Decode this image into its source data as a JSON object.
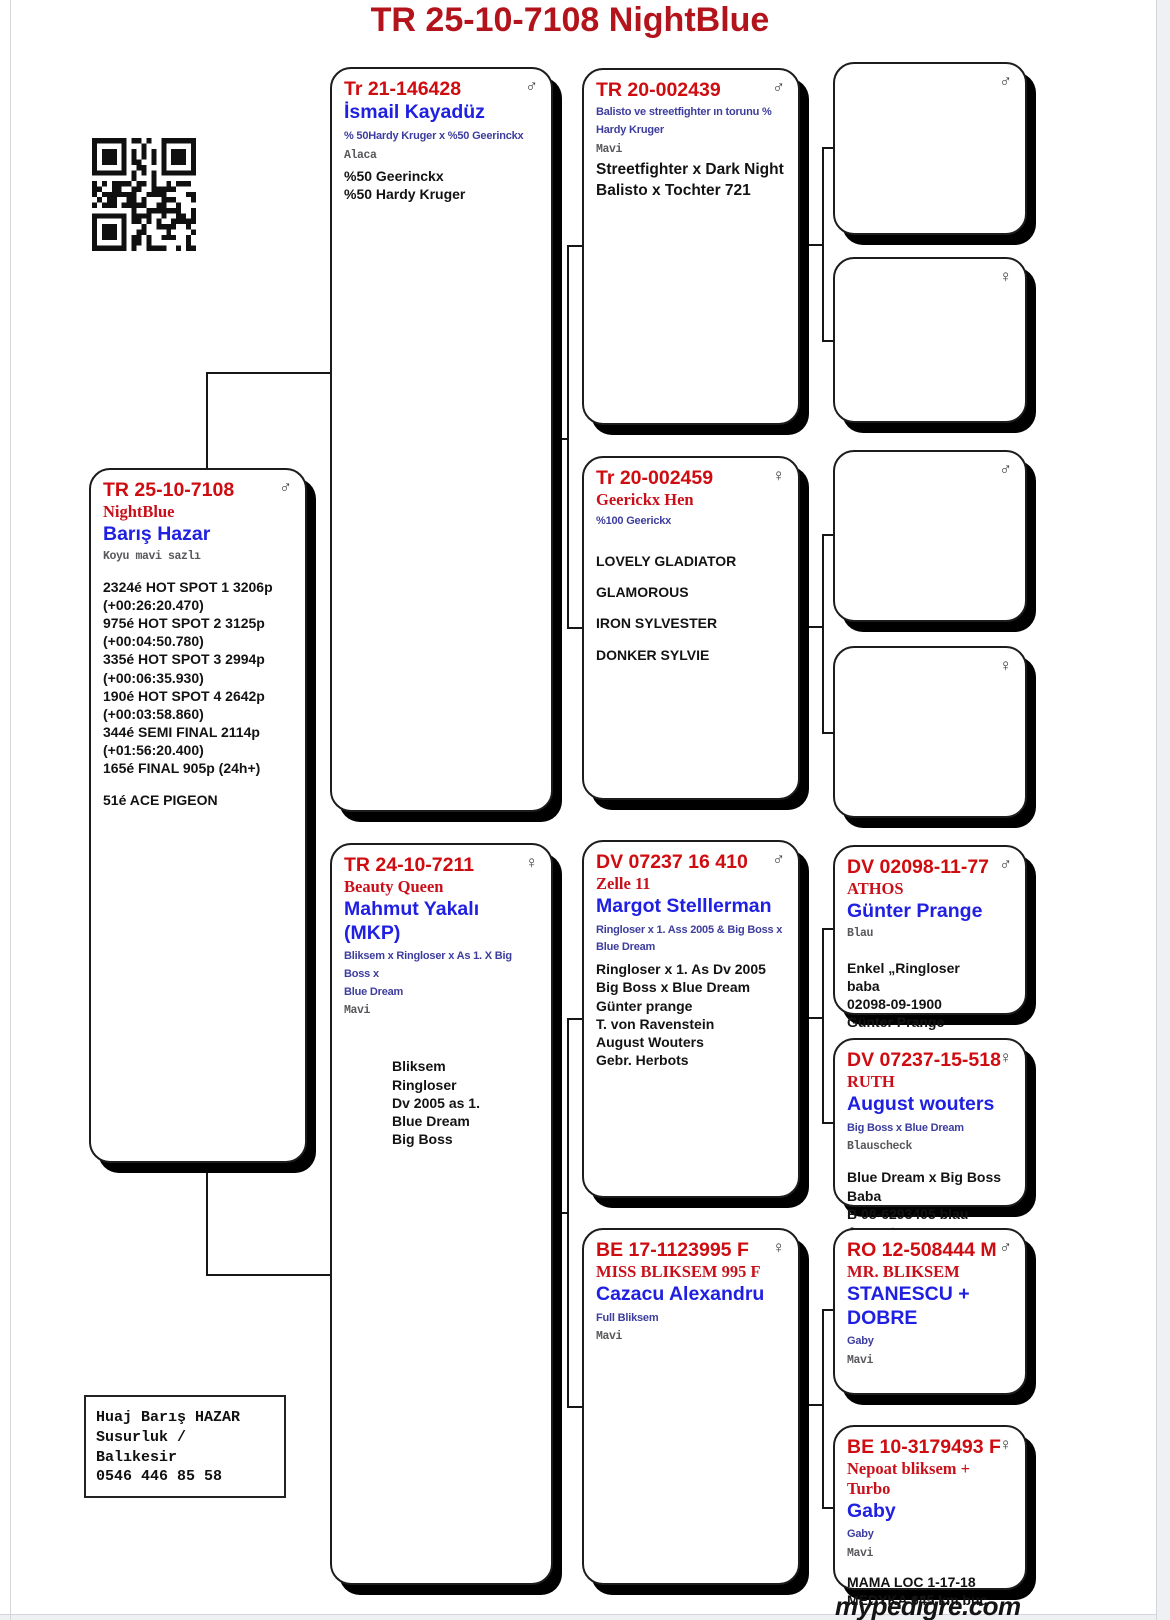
{
  "page": {
    "title": "TR 25-10-7108  NightBlue",
    "footer_logo": "mypedigre.com",
    "colors": {
      "title_red": "#b3141c",
      "ring_red": "#cf0c10",
      "name_blue": "#2020e2",
      "desc_blue": "#3d3d9f"
    }
  },
  "contact": {
    "lines": [
      "Huaj Barış HAZAR",
      "Susurluk / Balıkesir",
      "0546 446 85 58"
    ]
  },
  "boxes": {
    "subject": {
      "ring": "TR 25-10-7108",
      "sex": "♂",
      "name2": "NightBlue",
      "owner": "Barış Hazar",
      "color_line": "Koyu mavi sazlı",
      "info": [
        "2324é HOT SPOT 1 3206p",
        "(+00:26:20.470)",
        "975é HOT SPOT 2 3125p",
        "(+00:04:50.780)",
        "335é HOT SPOT 3 2994p",
        "(+00:06:35.930)",
        "190é HOT SPOT 4 2642p",
        "(+00:03:58.860)",
        "344é SEMI FINAL 2114p",
        "(+01:56:20.400)",
        "165é FINAL 905p (24h+)",
        "",
        "51é ACE PIGEON"
      ]
    },
    "sire": {
      "ring": "Tr 21-146428",
      "sex": "♂",
      "owner": "İsmail Kayadüz",
      "desc": [
        "% 50Hardy Kruger x %50 Geerinckx"
      ],
      "color_line": "Alaca",
      "info": [
        "%50 Geerinckx",
        "%50 Hardy Kruger"
      ]
    },
    "dam": {
      "ring": "TR 24-10-7211",
      "sex": "♀",
      "name2": "Beauty Queen",
      "owner": "Mahmut Yakalı (MKP)",
      "desc": [
        "Bliksem x Ringloser x As 1. X Big Boss x",
        "Blue Dream"
      ],
      "color_line": "Mavi",
      "info": [
        "Bliksem",
        "Ringloser",
        "Dv 2005 as 1.",
        "Blue Dream",
        "Big Boss"
      ]
    },
    "sgs": {
      "ring": "TR 20-002439",
      "sex": "♂",
      "desc": [
        "Balisto ve streetfighter ın torunu %",
        "Hardy Kruger"
      ],
      "color_line": "Mavi",
      "info": [
        "Streetfighter x Dark Night",
        "Balisto x Tochter 721"
      ]
    },
    "sgd": {
      "ring": "Tr 20-002459",
      "sex": "♀",
      "name2": "Geerickx Hen",
      "desc": [
        "%100 Geerickx"
      ],
      "info": [
        "LOVELY GLADIATOR",
        "",
        "GLAMOROUS",
        "",
        "IRON SYLVESTER",
        "",
        "DONKER SYLVIE"
      ]
    },
    "dgs": {
      "ring": "DV 07237 16 410",
      "sex": "♂",
      "name2": "Zelle 11",
      "owner": "Margot Stelllerman",
      "desc": [
        "Ringloser x 1. Ass 2005 & Big Boss x",
        "Blue Dream"
      ],
      "info": [
        "Ringloser x 1. As Dv 2005",
        "Big Boss x Blue Dream",
        "Günter prange",
        "T. von Ravenstein",
        "August Wouters",
        "Gebr. Herbots"
      ]
    },
    "dgd": {
      "ring": "BE 17-1123995 F",
      "sex": "♀",
      "name2": "MISS BLIKSEM 995 F",
      "owner": "Cazacu Alexandru",
      "desc": [
        "Full Bliksem"
      ],
      "color_line": "Mavi"
    },
    "g4_1": {
      "sex": "♂"
    },
    "g4_2": {
      "sex": "♀"
    },
    "g4_3": {
      "sex": "♂"
    },
    "g4_4": {
      "sex": "♀"
    },
    "g4_5": {
      "ring": "DV 02098-11-77",
      "sex": "♂",
      "name2": "ATHOS",
      "owner": "Günter Prange",
      "color_line": "Blau",
      "info": [
        "Enkel „Ringloser",
        "baba",
        "02098-09-1900",
        "Günter Prange"
      ]
    },
    "g4_6": {
      "ring": "DV 07237-15-518",
      "sex": "♀",
      "name2": "RUTH",
      "owner": "August wouters",
      "desc": [
        "Big Boss x Blue Dream"
      ],
      "color_line": "Blauscheck",
      "info": [
        "Blue Dream x Big Boss",
        "Baba",
        "B 08-6293405 blau August"
      ]
    },
    "g4_7": {
      "ring": "RO 12-508444 M",
      "sex": "♂",
      "name2": "MR. BLIKSEM",
      "owner": "STANESCU + DOBRE",
      "desc": [
        "Gaby"
      ],
      "color_line": "Mavi"
    },
    "g4_8": {
      "ring": "BE 10-3179493 F",
      "sex": "♀",
      "name2": "Nepoat bliksem + Turbo",
      "owner": "Gaby",
      "desc": [
        "Gaby"
      ],
      "color_line": "Mavi",
      "info": [
        "MAMA LOC 1-17-18",
        "MEDYKA 645 km buc"
      ],
      "info2": "2017"
    }
  }
}
